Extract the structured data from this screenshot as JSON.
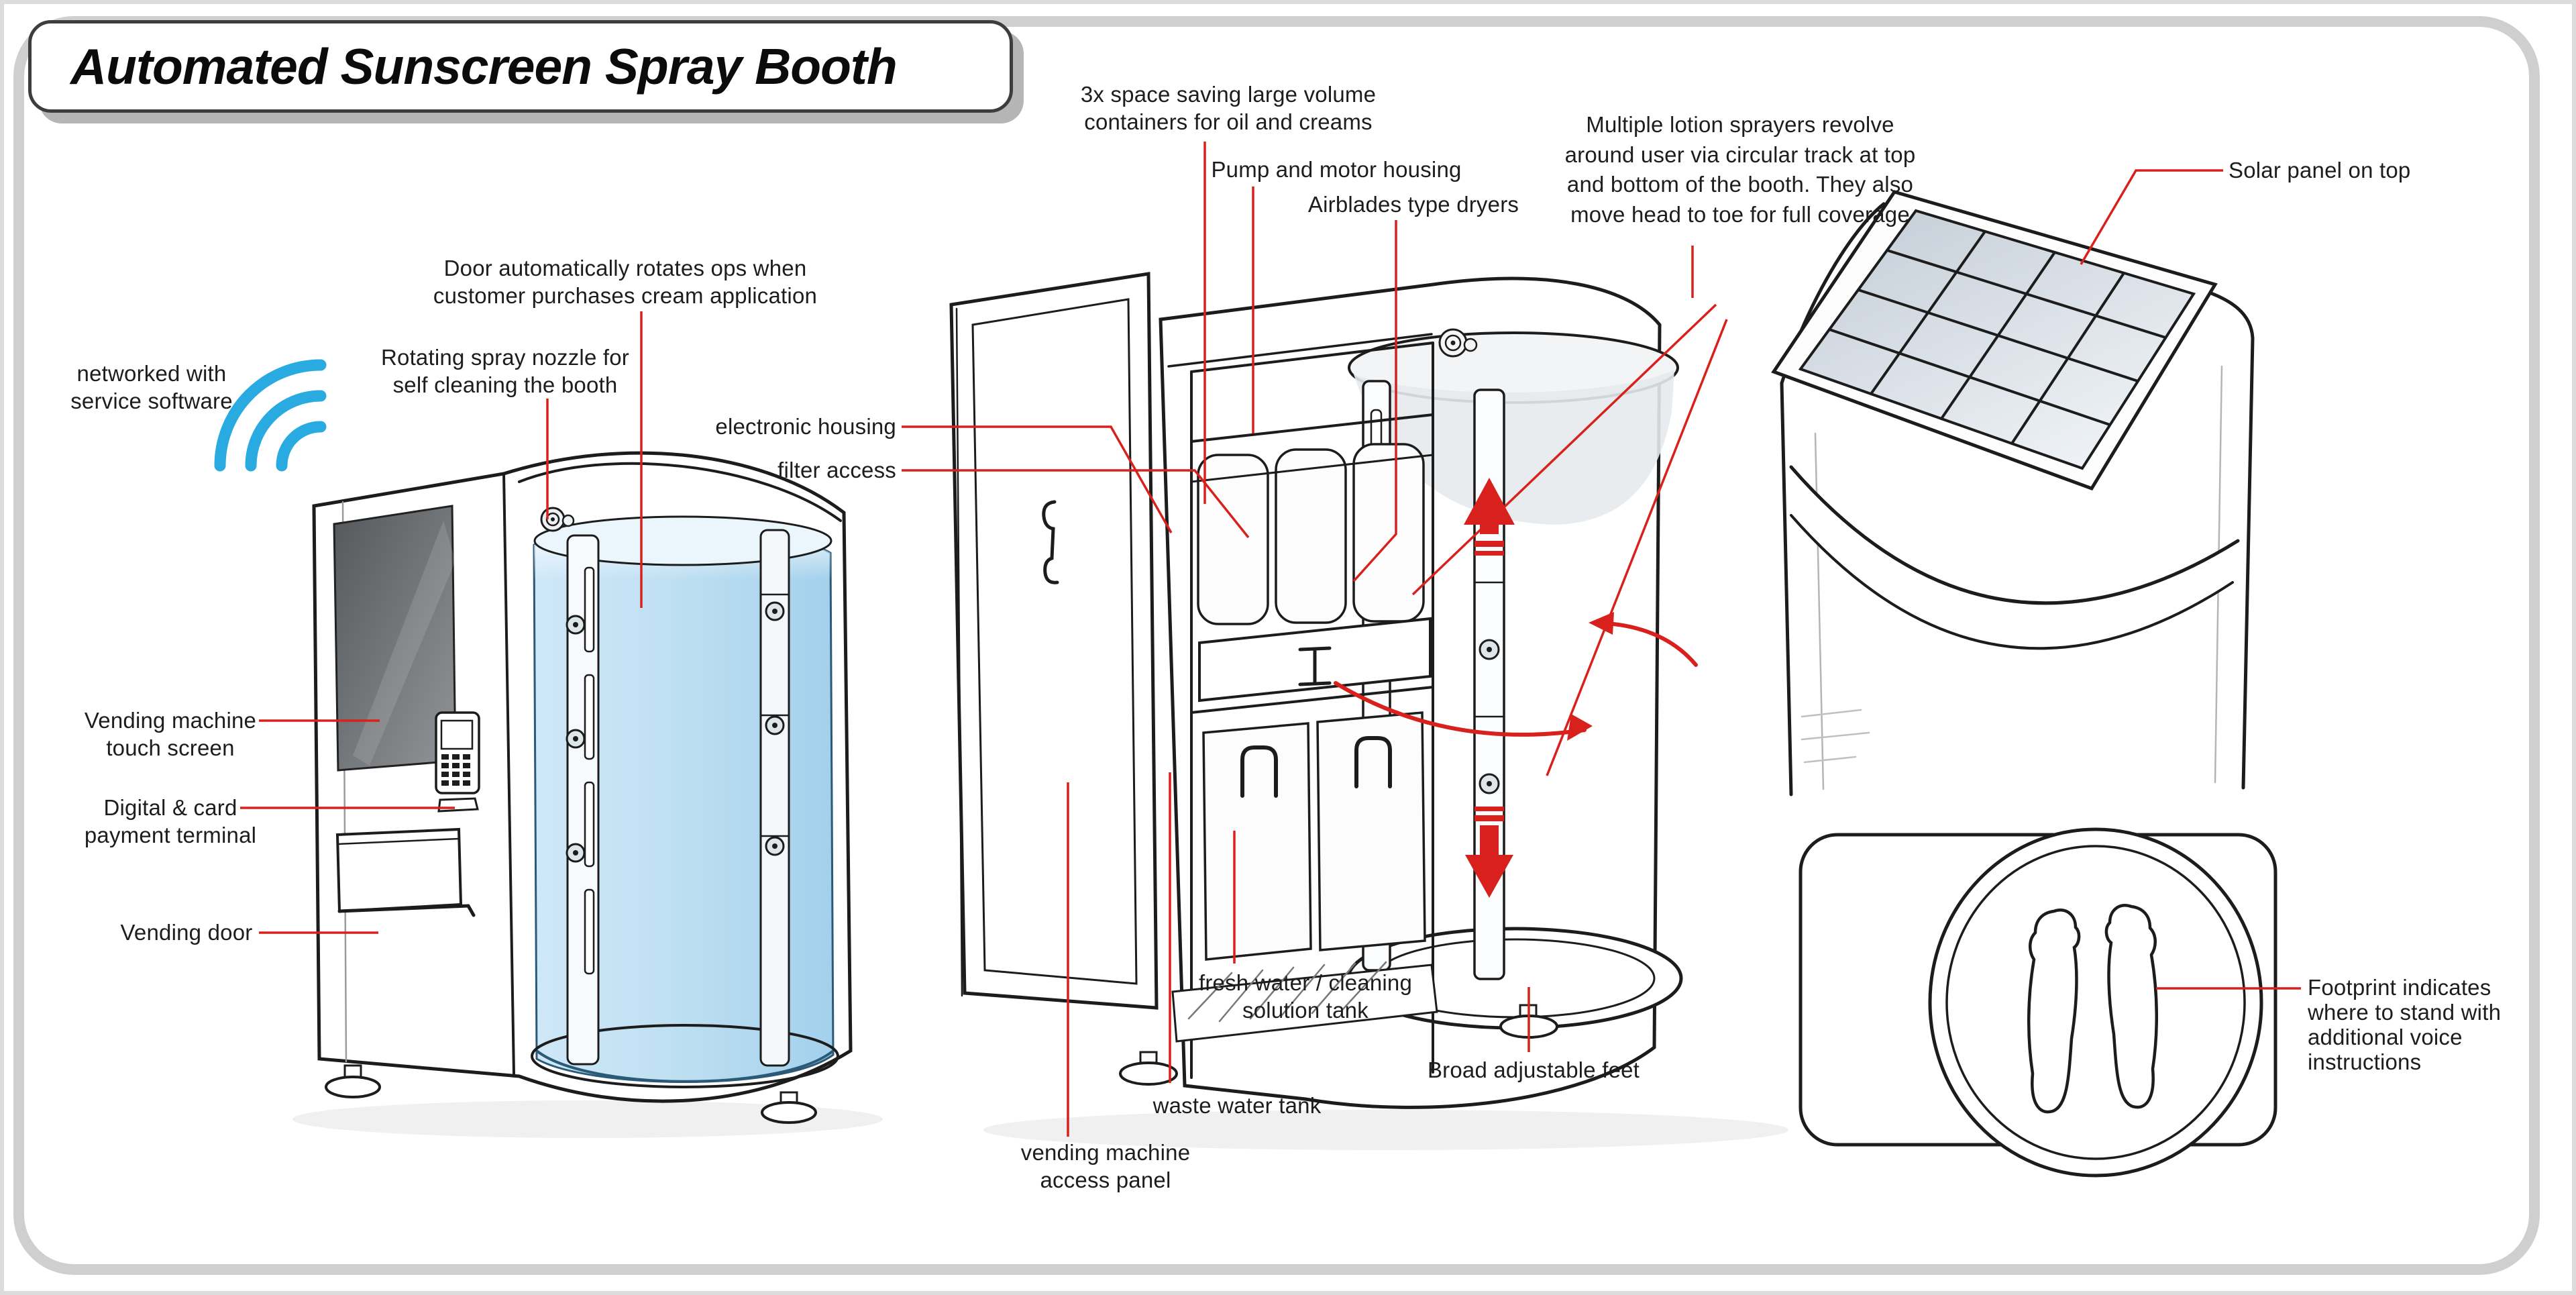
{
  "title": "Automated Sunscreen Spray Booth",
  "labels": {
    "networked": "networked with\nservice software",
    "door_rotates": "Door automatically rotates ops when\ncustomer purchases cream application",
    "rotating_nozzle": "Rotating spray nozzle for\nself cleaning the booth",
    "electronic_housing": "electronic housing",
    "filter_access": "filter access",
    "vending_touch": "Vending machine\ntouch screen",
    "payment_terminal": "Digital & card\npayment terminal",
    "vending_door": "Vending door",
    "containers": "3x space saving large volume\ncontainers for oil and creams",
    "pump_motor": "Pump and motor housing",
    "airblades": "Airblades type dryers",
    "sprayers": "Multiple lotion sprayers revolve\naround user via circular track at top\nand bottom of the booth. They also\nmove head to toe for full coverage",
    "solar": "Solar panel on top",
    "fresh_water": "fresh water / cleaning\nsolution tank",
    "waste_water": "waste water tank",
    "access_panel": "vending machine\naccess panel",
    "adjustable_feet": "Broad adjustable feet",
    "footprint": "Footprint indicates\nwhere to stand with\nadditional voice\ninstructions"
  },
  "icons": {
    "wifi": "wifi-arcs",
    "up_arrow": "red-up-arrow",
    "down_arrow": "red-down-arrow",
    "rotation": "red-rotation-arrows"
  },
  "colors": {
    "annotation_red": "#d8211d",
    "wifi_blue": "#29abe2",
    "glass_blue": "#bfe0f2",
    "screen_gray": "#6a6d70",
    "solar_cell": "#cdd5de",
    "sketch_ink": "#1c1c1c",
    "frame_gray": "#cfcfcf"
  }
}
